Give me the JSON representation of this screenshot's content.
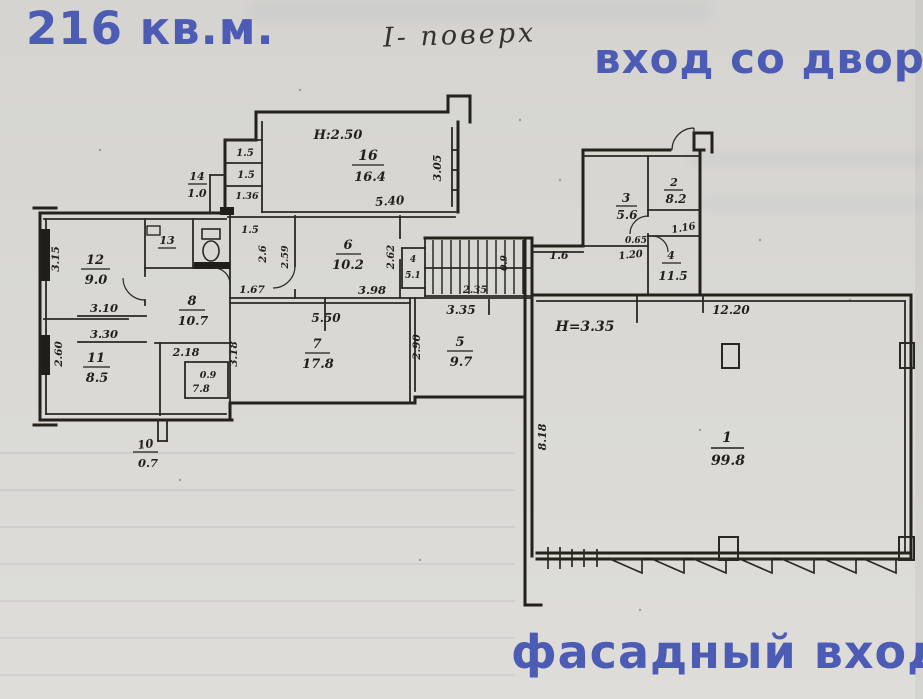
{
  "annotations": {
    "area_total": "216 кв.м.",
    "floor_note": "I- поверх",
    "entrance_yard": "вход со двора",
    "entrance_facade": "фасадный вход"
  },
  "colors": {
    "overlay_blue": "#4c5bb3",
    "ink": "#262419",
    "paper": "#d8d7d3"
  },
  "rooms": {
    "r1": {
      "num": "1",
      "area": "99.8"
    },
    "r2": {
      "num": "2",
      "area": "8.2"
    },
    "r3": {
      "num": "3",
      "area": "5.6"
    },
    "r4": {
      "num": "4",
      "area": "11.5"
    },
    "r5": {
      "num": "5",
      "area": "9.7"
    },
    "r6": {
      "num": "6",
      "area": "10.2"
    },
    "r7": {
      "num": "7",
      "area": "17.8"
    },
    "r8": {
      "num": "8",
      "area": "10.7"
    },
    "r10": {
      "num": "10",
      "area": "0.7"
    },
    "r11": {
      "num": "11",
      "area": "8.5"
    },
    "r12": {
      "num": "12",
      "area": "9.0"
    },
    "r13": {
      "num": "13"
    },
    "r14": {
      "num": "14",
      "area": "1.0"
    },
    "r16": {
      "num": "16",
      "area": "16.4"
    }
  },
  "dims": {
    "h250": "H:2.50",
    "h335": "H=3.35",
    "d540": "5.40",
    "d305": "3.05",
    "d15a": "1.5",
    "d15b": "1.5",
    "d136": "1.36",
    "d315": "3.15",
    "d310": "3.10",
    "d330": "3.30",
    "d260": "2.60",
    "d15c": "1.5",
    "d26": "2.6",
    "d259": "2.59",
    "d167": "1.67",
    "d398": "3.98",
    "d262": "2.62",
    "d550": "5.50",
    "d318": "3.18",
    "d290": "2.90",
    "d335": "3.35",
    "d235": "2.35",
    "d218": "2.18",
    "d09a": "0.9",
    "d09b": "0.9",
    "d78": "7.8",
    "d4": "4",
    "d51": "5.1",
    "d16": "1.6",
    "d120": "1.20",
    "d116": "1.16",
    "d065": "0.65",
    "d1220": "12.20",
    "d818": "8.18"
  }
}
